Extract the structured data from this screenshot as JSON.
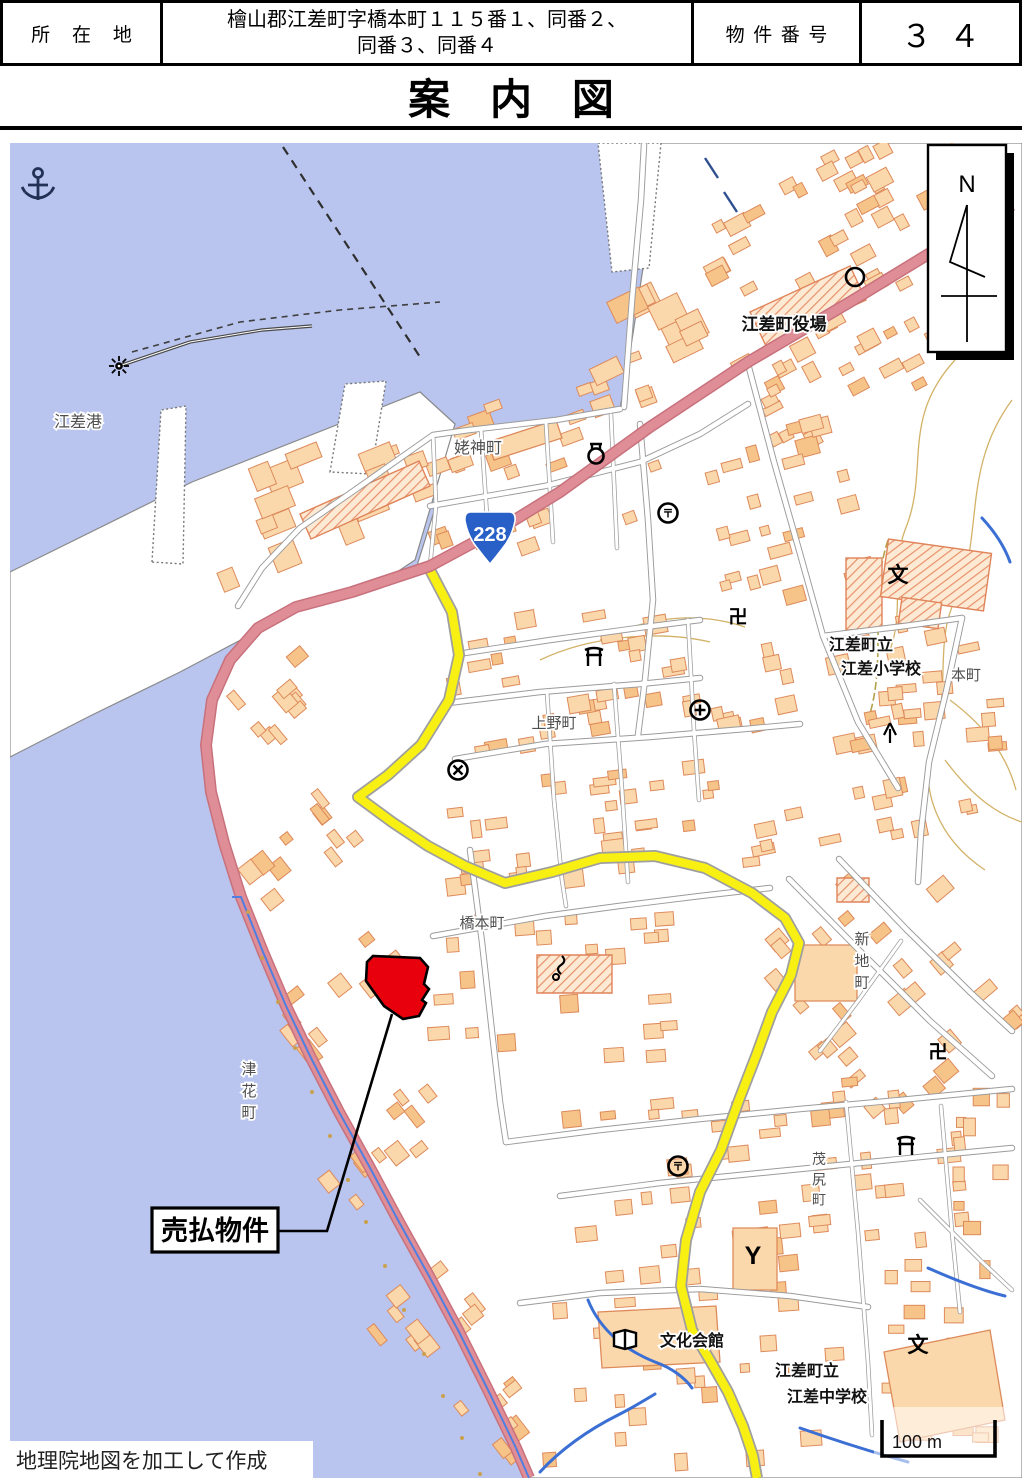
{
  "header": {
    "location_label": "所在地",
    "address_line1": "檜山郡江差町字橋本町１１５番１、同番２、",
    "address_line2": "同番３、同番４",
    "property_number_label": "物件番号",
    "property_number_value": "３４"
  },
  "title": "案内図",
  "map": {
    "attribution": "地理院地図を加工して作成",
    "scale_label": "100 m",
    "compass_letter": "N",
    "route_shield": "228",
    "callout_label": "売払物件",
    "labels": [
      {
        "id": "esashi-port",
        "text": "江差港",
        "x": 78,
        "y": 427,
        "size": 16,
        "style": "town"
      },
      {
        "id": "ubagami-cho",
        "text": "姥神町",
        "x": 478,
        "y": 453,
        "size": 16,
        "style": "town"
      },
      {
        "id": "esashi-town-hall",
        "text": "江差町役場",
        "x": 784,
        "y": 330,
        "size": 17,
        "style": "fac"
      },
      {
        "id": "hon-cho",
        "text": "本町",
        "x": 966,
        "y": 680,
        "size": 15,
        "style": "town"
      },
      {
        "id": "esashi-elementary-1",
        "text": "江差町立",
        "x": 861,
        "y": 650,
        "size": 16,
        "style": "fac"
      },
      {
        "id": "esashi-elementary-2",
        "text": "江差小学校",
        "x": 881,
        "y": 674,
        "size": 16,
        "style": "fac"
      },
      {
        "id": "ueno-cho",
        "text": "上野町",
        "x": 554,
        "y": 728,
        "size": 15,
        "style": "town"
      },
      {
        "id": "hashimoto-cho",
        "text": "橋本町",
        "x": 482,
        "y": 928,
        "size": 15,
        "style": "town"
      },
      {
        "id": "shinchi-cho",
        "text": "新地町",
        "x": 862,
        "y": 944,
        "size": 15,
        "style": "town",
        "vertical": true
      },
      {
        "id": "tsubana-cho",
        "text": "津花町",
        "x": 249,
        "y": 1074,
        "size": 15,
        "style": "town",
        "vertical": true
      },
      {
        "id": "moshiri-cho",
        "text": "茂尻町",
        "x": 819,
        "y": 1164,
        "size": 14,
        "style": "town",
        "vertical": true
      },
      {
        "id": "culture-hall",
        "text": "文化会館",
        "x": 692,
        "y": 1346,
        "size": 16,
        "style": "fac"
      },
      {
        "id": "esashi-jhs-1",
        "text": "江差町立",
        "x": 807,
        "y": 1376,
        "size": 16,
        "style": "fac"
      },
      {
        "id": "esashi-jhs-2",
        "text": "江差中学校",
        "x": 827,
        "y": 1402,
        "size": 16,
        "style": "fac"
      }
    ],
    "symbols": [
      {
        "name": "anchor-icon",
        "x": 38,
        "y": 186
      },
      {
        "name": "lighthouse-icon",
        "x": 119,
        "y": 366
      },
      {
        "name": "town-office-icon",
        "x": 855,
        "y": 277
      },
      {
        "name": "landmark-bottle-icon",
        "x": 596,
        "y": 453
      },
      {
        "name": "post-office-icon",
        "x": 668,
        "y": 513
      },
      {
        "name": "temple-icon",
        "x": 738,
        "y": 617
      },
      {
        "name": "shrine-icon",
        "x": 594,
        "y": 657
      },
      {
        "name": "hospital-icon",
        "x": 700,
        "y": 710
      },
      {
        "name": "police-icon",
        "x": 458,
        "y": 770
      },
      {
        "name": "school-icon",
        "x": 898,
        "y": 575
      },
      {
        "name": "tree-icon",
        "x": 890,
        "y": 733
      },
      {
        "name": "crane-icon",
        "x": 560,
        "y": 968
      },
      {
        "name": "temple-icon",
        "x": 938,
        "y": 1052
      },
      {
        "name": "shrine-icon",
        "x": 906,
        "y": 1146
      },
      {
        "name": "post-office-icon",
        "x": 678,
        "y": 1166
      },
      {
        "name": "fire-station-icon",
        "x": 753,
        "y": 1256
      },
      {
        "name": "library-icon",
        "x": 625,
        "y": 1338
      },
      {
        "name": "school-icon",
        "x": 918,
        "y": 1345
      }
    ],
    "colors": {
      "water": "#b9c5ee",
      "building_fill": "#fbd8ab",
      "building_stroke": "#dd8a5b",
      "main_road": "#df8d97",
      "highlight_road": "#f8ef13",
      "parcel_red": "#e8000d",
      "shield_blue": "#2860c8"
    }
  }
}
